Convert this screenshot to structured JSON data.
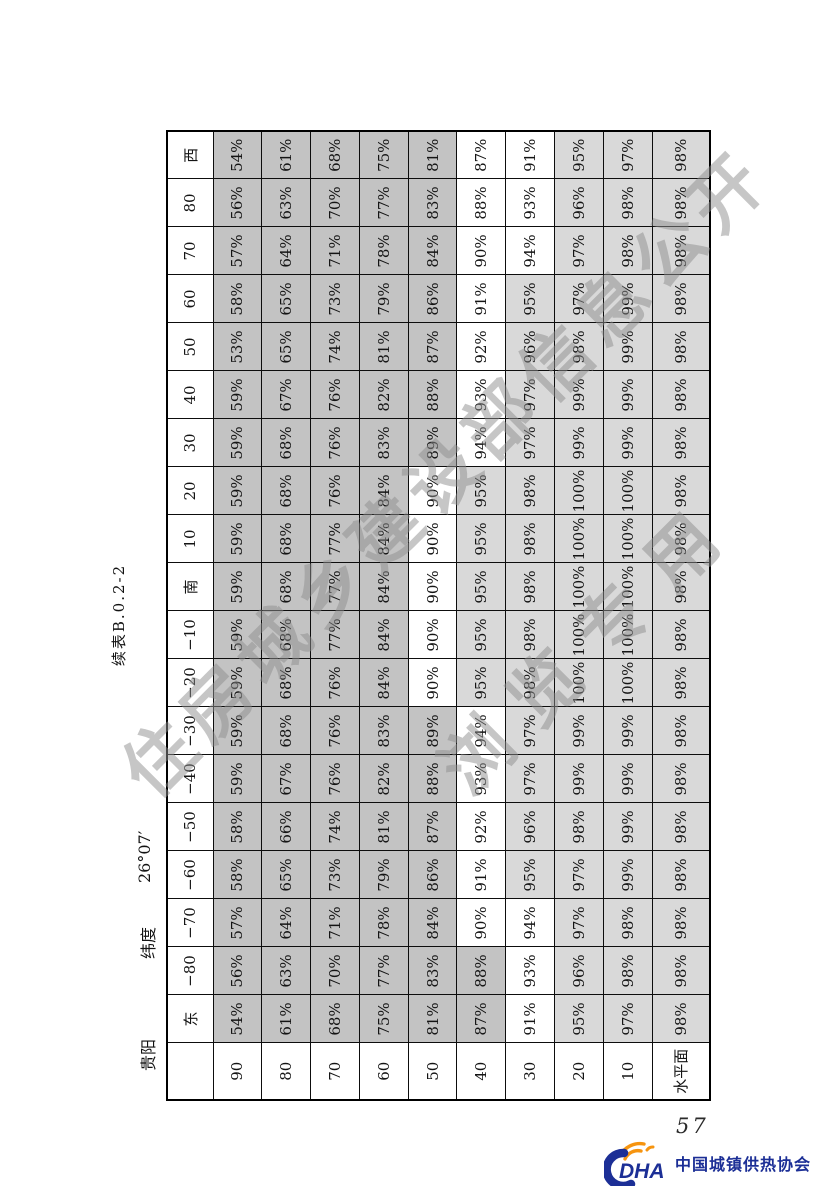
{
  "page": {
    "title": "续表B.0.2-2",
    "city": "贵阳",
    "latitude_label": "纬度",
    "latitude_value": "26°07′",
    "page_number": "57",
    "watermark": {
      "line1": "住房城乡建设部信息公开",
      "line2": "浏览专用"
    },
    "footer_logo": {
      "abbr": "DHA",
      "org_name": "中国城镇供热协会",
      "blue": "#1c2f96",
      "orange": "#f6940f"
    },
    "colors": {
      "cell_dark": "#c3c3c3",
      "cell_light": "#d9d9d9",
      "cell_white": "#ffffff",
      "border": "#0d0d0d",
      "watermark_gray": "#8e8e8e"
    }
  },
  "chart_data": {
    "type": "table",
    "title": "续表B.0.2-2",
    "unit": "%",
    "corner_label": "",
    "column_headers": [
      "东",
      "−80",
      "−70",
      "−60",
      "−50",
      "−40",
      "−30",
      "−20",
      "−10",
      "南",
      "10",
      "20",
      "30",
      "40",
      "50",
      "60",
      "70",
      "80",
      "西"
    ],
    "row_headers": [
      "90",
      "80",
      "70",
      "60",
      "50",
      "40",
      "30",
      "20",
      "10",
      "水平面"
    ],
    "values": [
      [
        54,
        56,
        57,
        58,
        58,
        59,
        59,
        59,
        59,
        59,
        59,
        59,
        59,
        59,
        53,
        58,
        57,
        56,
        54
      ],
      [
        61,
        63,
        64,
        65,
        66,
        67,
        68,
        68,
        68,
        68,
        68,
        68,
        68,
        67,
        65,
        65,
        64,
        63,
        61
      ],
      [
        68,
        70,
        71,
        73,
        74,
        76,
        76,
        76,
        77,
        77,
        77,
        76,
        76,
        76,
        74,
        73,
        71,
        70,
        68
      ],
      [
        75,
        77,
        78,
        79,
        81,
        82,
        83,
        84,
        84,
        84,
        84,
        84,
        83,
        82,
        81,
        79,
        78,
        77,
        75
      ],
      [
        81,
        83,
        84,
        86,
        87,
        88,
        89,
        90,
        90,
        90,
        90,
        90,
        89,
        88,
        87,
        86,
        84,
        83,
        81
      ],
      [
        87,
        88,
        90,
        91,
        92,
        93,
        94,
        95,
        95,
        95,
        95,
        95,
        94,
        93,
        92,
        91,
        90,
        88,
        87
      ],
      [
        91,
        93,
        94,
        95,
        96,
        97,
        97,
        98,
        98,
        98,
        98,
        98,
        97,
        97,
        96,
        95,
        94,
        93,
        91
      ],
      [
        95,
        96,
        97,
        97,
        98,
        99,
        99,
        100,
        100,
        100,
        100,
        100,
        99,
        99,
        98,
        97,
        97,
        96,
        95
      ],
      [
        97,
        98,
        98,
        99,
        99,
        99,
        99,
        100,
        100,
        100,
        100,
        100,
        99,
        99,
        99,
        99,
        98,
        98,
        97
      ],
      [
        98,
        98,
        98,
        98,
        98,
        98,
        98,
        98,
        98,
        98,
        98,
        98,
        98,
        98,
        98,
        98,
        98,
        98,
        98
      ]
    ],
    "cell_shading_by_column": [
      "ddddddwlll",
      "ddddddwlll",
      "dddddwwlll",
      "dddddwllll",
      "dddddwllll",
      "dddddwllll",
      "dddddwllll",
      "ddddwlllll",
      "ddddwlllll",
      "ddddwlllll",
      "ddddwlllll",
      "ddddwlllll",
      "dddddwllll",
      "dddddwllll",
      "dddddwllll",
      "dddddwllll",
      "dddddwwlll",
      "dddddwwlll",
      "dddddwwlll"
    ],
    "shading_legend": {
      "d": "dark-gray",
      "w": "white",
      "l": "light-gray"
    },
    "layout_note": "table is rotated 90deg counter-clockwise on the printed page"
  }
}
